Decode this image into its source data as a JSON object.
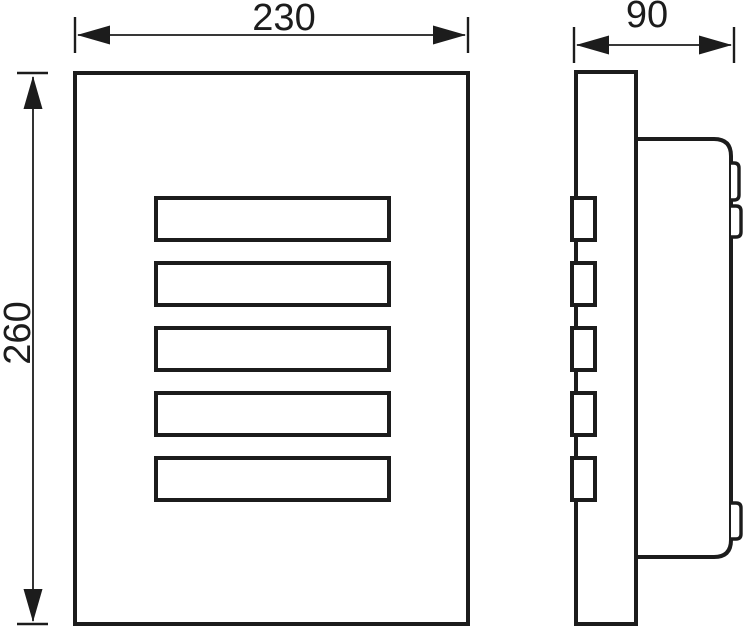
{
  "drawing": {
    "description": "Orthographic technical drawing of a louvered rectangular fixture: front view (left) and side profile view (right) with overall dimensions, no units shown",
    "background_color": "#ffffff",
    "line_color": "#1c1c1c",
    "dimensions": {
      "width": {
        "value": "230",
        "view": "front",
        "axis": "horizontal",
        "label_rotation_deg": 0
      },
      "height": {
        "value": "260",
        "view": "front",
        "axis": "vertical",
        "label_rotation_deg": -90
      },
      "depth": {
        "value": "90",
        "view": "side",
        "axis": "horizontal",
        "label_rotation_deg": 0
      }
    },
    "front_view": {
      "slat_count": 5,
      "slats": {
        "x": 156,
        "width": 233,
        "height": 42,
        "tops": [
          198,
          263,
          328,
          393,
          458
        ]
      }
    },
    "side_view": {
      "notch_count": 5,
      "notches": {
        "x": 572,
        "width": 23,
        "height": 42,
        "tops": [
          198,
          263,
          328,
          393,
          458
        ]
      },
      "mounting_tab_count": 3
    }
  }
}
